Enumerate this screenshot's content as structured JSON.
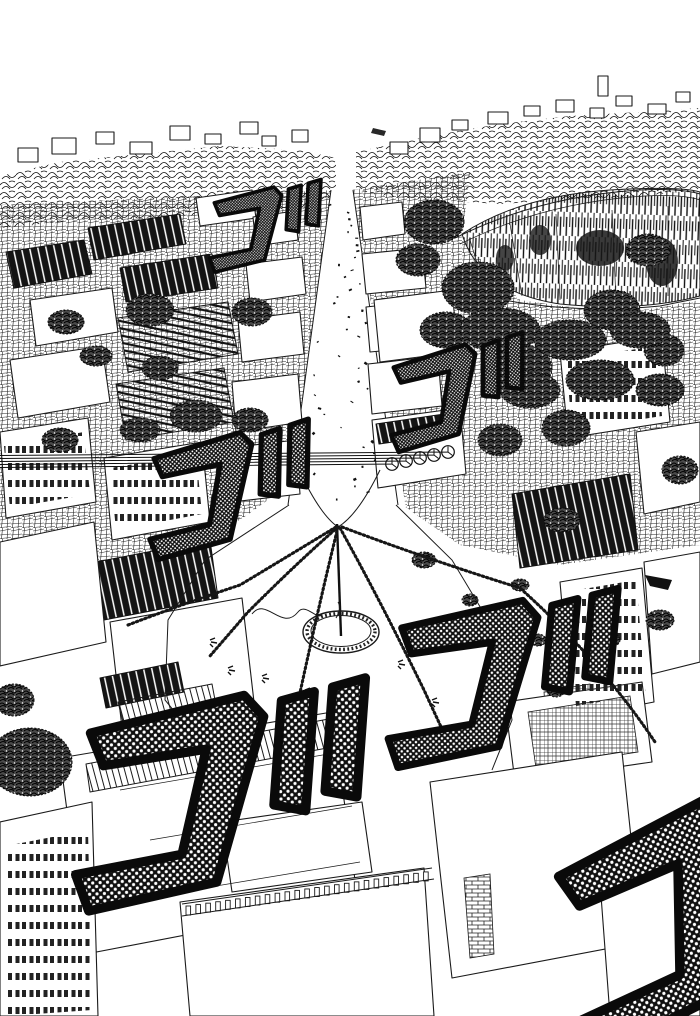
{
  "panel": {
    "description": "Black-and-white manga panel: bird's-eye view of a dense city. A wide avenue converges on a circular plaza with a guy-wired pole and ring basin; rooftops and trees crowd both sides, a large impact crater gapes at the upper right, and giant rumbling sound-effect characters overlay the scene.",
    "ink_color": "#1a1a1a",
    "paper_color": "#ffffff",
    "sfx": {
      "character": "ゴ",
      "reading": "go",
      "meaning": "rumble / ominous roar",
      "instances": [
        {
          "id": "go-1",
          "x": 212,
          "y": 190,
          "scale": 0.72,
          "rotate": -4
        },
        {
          "id": "go-2",
          "x": 150,
          "y": 440,
          "scale": 1.05,
          "rotate": -6
        },
        {
          "id": "go-3",
          "x": 390,
          "y": 352,
          "scale": 0.88,
          "rotate": -7
        },
        {
          "id": "go-4",
          "x": 398,
          "y": 602,
          "scale": 1.45,
          "rotate": -2
        },
        {
          "id": "go-5",
          "x": 85,
          "y": 700,
          "scale": 1.85,
          "rotate": -3
        },
        {
          "id": "go-6",
          "x": 545,
          "y": 845,
          "scale": 1.9,
          "rotate": -17
        }
      ]
    },
    "scene_features": [
      "distant skyline band",
      "impact crater upper right",
      "tree clusters",
      "central avenue with debris",
      "circular plaza with pole and ring basin",
      "guy-wires and chain garlands",
      "dense hatched rooftops",
      "large foreground rooftops with balustrade"
    ]
  }
}
